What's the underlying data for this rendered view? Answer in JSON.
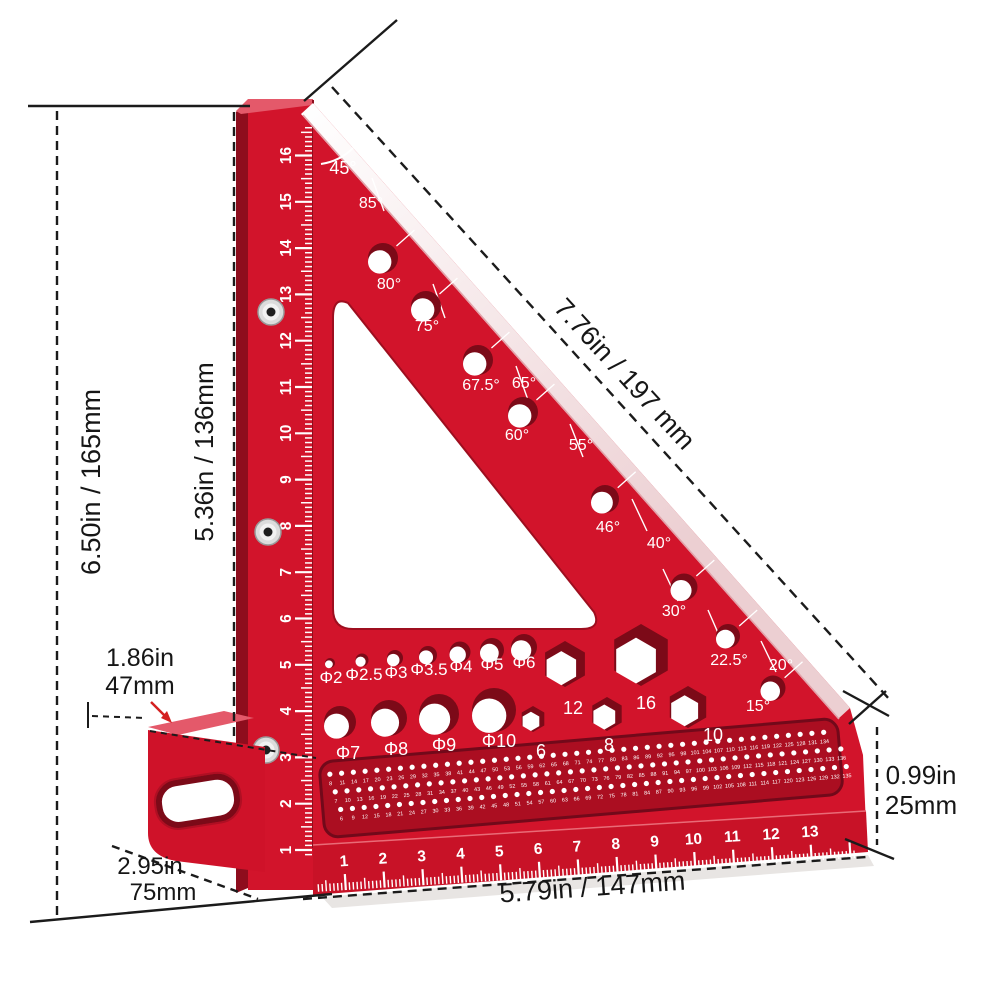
{
  "dimensions": {
    "overall_height": "6.50in / 165mm",
    "inner_height": "5.36in / 136mm",
    "hypotenuse": "7.76in / 197 mm",
    "base_length": "5.79in / 147mm",
    "edge_thickness": [
      "0.99in",
      "25mm"
    ],
    "foot_height": [
      "1.86in",
      "47mm"
    ],
    "base_depth": [
      "2.95in",
      "75mm"
    ]
  },
  "angle_labels": [
    "45°",
    "85°",
    "80°",
    "75°",
    "67.5°",
    "65°",
    "60°",
    "55°",
    "46°",
    "40°",
    "30°",
    "22.5°",
    "20°",
    "15°"
  ],
  "hole_labels": {
    "small": [
      "Φ2",
      "Φ2.5",
      "Φ3",
      "Φ3.5",
      "Φ4",
      "Φ5",
      "Φ6"
    ],
    "large": [
      "Φ7",
      "Φ8",
      "Φ9",
      "Φ10"
    ],
    "hex": [
      "12",
      "16",
      "6",
      "8",
      "10"
    ]
  },
  "rulers": {
    "vertical_cm": [
      "1",
      "2",
      "3",
      "4",
      "5",
      "6",
      "7",
      "8",
      "9",
      "10",
      "11",
      "12",
      "13",
      "14",
      "15",
      "16"
    ],
    "bottom_cm": [
      "1",
      "2",
      "3",
      "4",
      "5",
      "6",
      "7",
      "8",
      "9",
      "10",
      "11",
      "12",
      "13"
    ]
  },
  "dot_grid_rows": [
    [
      8,
      11,
      14,
      17,
      20,
      23,
      26,
      29,
      32,
      35,
      38,
      41,
      44,
      47,
      50,
      53,
      56,
      59,
      62,
      65,
      68,
      71,
      74,
      77,
      80,
      83,
      86,
      89,
      92,
      95,
      98,
      101,
      104,
      107,
      110,
      113,
      116,
      119,
      122,
      125,
      128,
      131,
      134
    ],
    [
      7,
      10,
      13,
      16,
      19,
      22,
      25,
      28,
      31,
      34,
      37,
      40,
      43,
      46,
      49,
      52,
      55,
      58,
      61,
      64,
      67,
      70,
      73,
      76,
      79,
      82,
      85,
      88,
      91,
      94,
      97,
      100,
      103,
      106,
      109,
      112,
      115,
      118,
      121,
      124,
      127,
      130,
      133,
      136
    ],
    [
      6,
      9,
      12,
      15,
      18,
      21,
      24,
      27,
      30,
      33,
      36,
      39,
      42,
      45,
      48,
      51,
      54,
      57,
      60,
      63,
      66,
      69,
      72,
      75,
      78,
      81,
      84,
      87,
      90,
      93,
      96,
      99,
      102,
      105,
      108,
      111,
      114,
      117,
      120,
      123,
      126,
      129,
      132,
      135
    ]
  ],
  "colors": {
    "body_red": "#d2142b",
    "band_red": "#c81227",
    "side_red": "#8e0d1d",
    "top_red": "#e4596a",
    "slot_red": "#ab0e21",
    "hole_dark": "#7c0a18",
    "chamfer_light": "#f6e7e8",
    "dimension_line": "#1b1b1b",
    "arrow_red": "#d42020",
    "white": "#ffffff"
  }
}
